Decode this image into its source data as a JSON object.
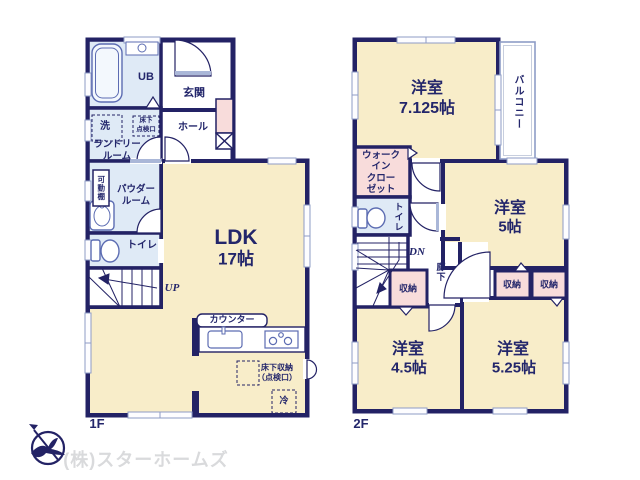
{
  "f1": {
    "label": "1F",
    "ub": "UB",
    "entrance": "玄関",
    "hall": "ホール",
    "wash": "洗",
    "hatch": "床下\n点検口",
    "laundry": "ランドリー\nルーム",
    "shelf": "可動棚",
    "powder": "パウダー\nルーム",
    "toilet": "トイレ",
    "ldk": "LDK",
    "ldk_size": "17帖",
    "up": "UP",
    "counter": "カウンター",
    "floor_storage": "床下収納\n（点検口）",
    "fridge": "冷"
  },
  "f2": {
    "label": "2F",
    "r1": "洋室",
    "r1s": "7.125帖",
    "balcony": "バルコニー",
    "wic": "ウォーク\nイン\nクロー\nゼット",
    "toilet": "トイレ",
    "dn": "DN",
    "corridor": "廊下",
    "st1": "収納",
    "st2": "収納",
    "st3": "収納",
    "r2": "洋室",
    "r2s": "5帖",
    "r3": "洋室",
    "r3s": "4.5帖",
    "r4": "洋室",
    "r4s": "5.25帖"
  },
  "footer": {
    "company": "(株)スターホームズ"
  },
  "colors": {
    "wall": "#232265",
    "room_cream": "#f8edc9",
    "room_blue": "#dfeaf6",
    "room_pink": "#f8dcdb",
    "window": "#8e9cc6",
    "text": "#23266b",
    "watermark": "#d9dadc"
  }
}
